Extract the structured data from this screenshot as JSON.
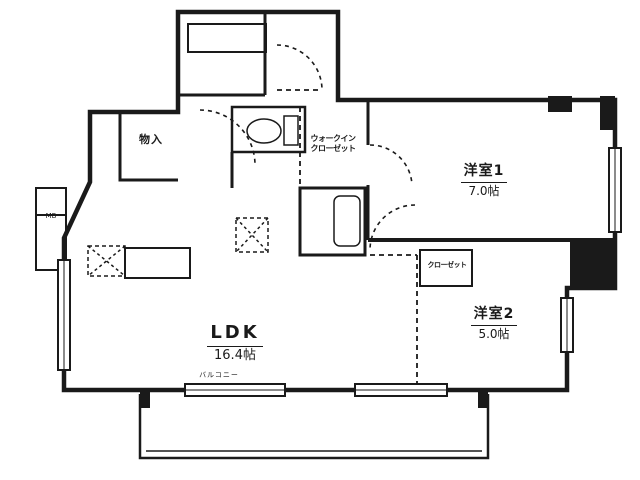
{
  "title": "間取り図",
  "colors": {
    "line": "#1a1a1a",
    "background": "#ffffff"
  },
  "rooms": {
    "ldk": {
      "name": "LDK",
      "size": "16.4帖"
    },
    "bedroom1": {
      "name": "洋室1",
      "size": "7.0帖"
    },
    "bedroom2": {
      "name": "洋室2",
      "size": "5.0帖"
    },
    "wic": {
      "line1": "ウォークイン",
      "line2": "クローゼット"
    },
    "storage": {
      "name": "物入"
    },
    "closet": {
      "name": "クローゼット"
    },
    "balcony": {
      "name": "バルコニー"
    },
    "meter_box": {
      "name": "MB"
    }
  },
  "fixtures": {
    "toilet": "toilet-bowl",
    "bathtub": "bathtub",
    "kitchen": "kitchen-counter",
    "refrigerator_space": "dashed-x-box",
    "washer_space": "dashed-x-box"
  }
}
